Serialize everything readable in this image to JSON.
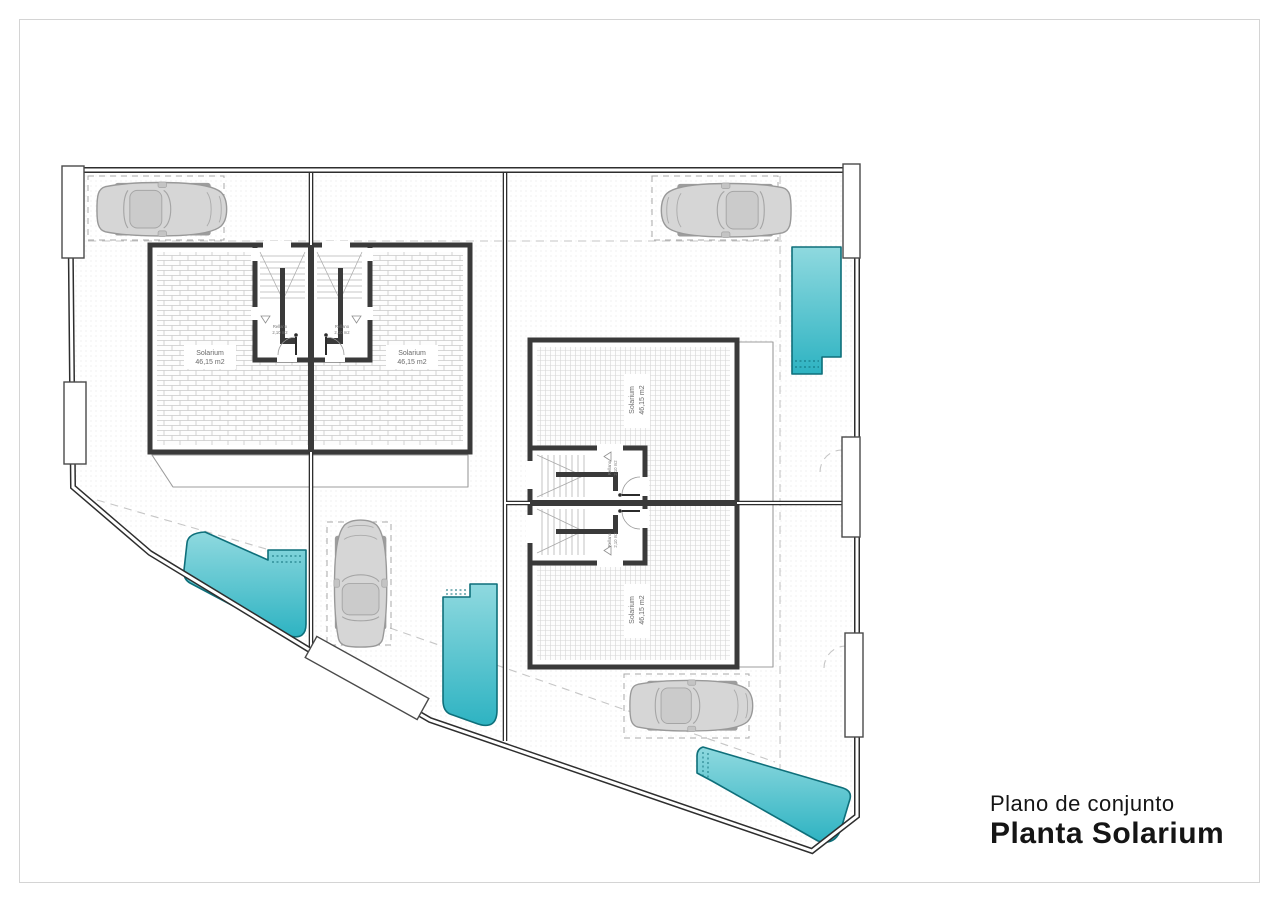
{
  "title_block": {
    "subtitle": "Plano de conjunto",
    "title": "Planta Solarium"
  },
  "labels": {
    "solarium": "Solarium",
    "solarium_area": "46,15 m2",
    "landing": "Rellano",
    "landing_area": "2,10 m2"
  },
  "colors": {
    "pool": "#2EB3C2",
    "pool_light": "#8FD9DF",
    "pool_dark": "#0E6F7A",
    "wall": "#3A3A3A",
    "boundary": "#2E2E2E",
    "dash": "#A8A8A8",
    "hatch_line": "#C9C9C9",
    "car_body": "#D6D6D6"
  }
}
